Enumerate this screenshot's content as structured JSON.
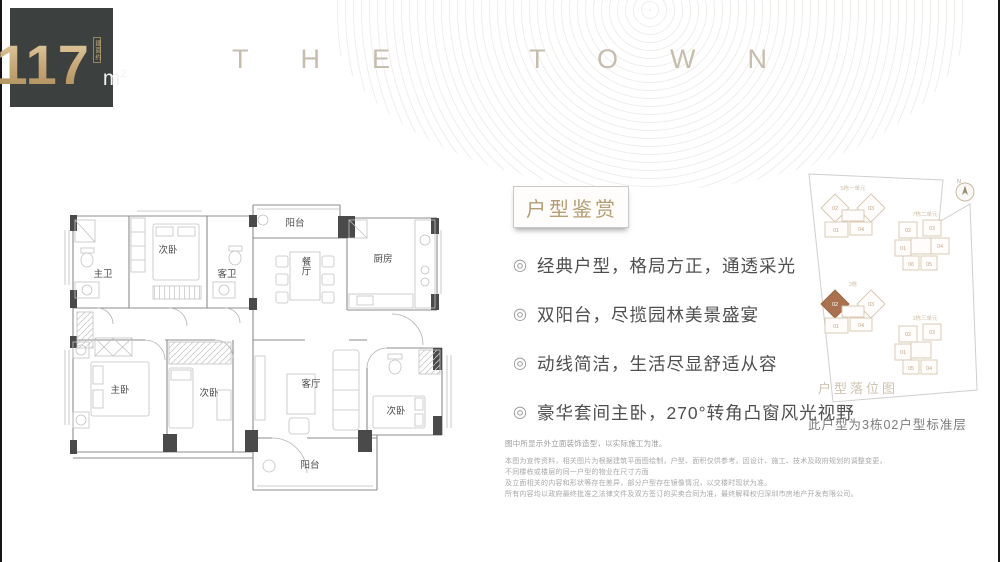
{
  "badge": {
    "prefix_vertical": "建面约",
    "value": "117",
    "unit_base": "m",
    "unit_exp": "2"
  },
  "brand": {
    "text": "THE TOWN"
  },
  "floorplan": {
    "labels": {
      "balcony_top": "阳台",
      "bedroom_top": "次卧",
      "master_bath": "主卫",
      "guest_bath": "客卫",
      "dining": "餐厅",
      "kitchen": "厨房",
      "master_bedroom": "主卧",
      "bedroom_mid": "次卧",
      "living_room": "客厅",
      "bedroom_right": "次卧",
      "balcony_bottom": "阳台"
    }
  },
  "features": {
    "title": "户型鉴赏",
    "bullet_icon": "◎",
    "items": [
      "经典户型，格局方正，通透采光",
      "双阳台，尽揽园林美景盛宴",
      "动线简洁，生活尽显舒适从容",
      "豪华套间主卧，270°转角凸窗风光视野"
    ]
  },
  "siteplan": {
    "title": "户型落位图",
    "caption": "此户型为3栋02户型标准层",
    "compass_label": "N",
    "highlight_color": "#aa7150",
    "clusters": {
      "a": {
        "label": "5栋一单元",
        "u1": "02",
        "u2": "03",
        "u3": "01",
        "u4": "04"
      },
      "b": {
        "label": "3栋",
        "u1": "02",
        "u2": "03",
        "u3": "01",
        "u4": "04"
      },
      "c": {
        "label": "7栋二单元",
        "u1": "02",
        "u2": "03",
        "u3": "01",
        "u4": "04",
        "u5": "06",
        "u6": "05"
      },
      "d": {
        "label": "1栋三单元",
        "u1": "02",
        "u2": "03",
        "u3": "01",
        "u4": "05",
        "u5": "04"
      }
    }
  },
  "disclaimer": {
    "line1": "图中所显示外立面装饰造型，以实际施工为准。",
    "para1": "本图为宣传资料，相关图片为根据建筑平面图绘制，户型、面积仅供参考，因设计、施工、技术及政府规划的调整变更，不同楼栋或楼层的同一户型的物业在尺寸方面",
    "para2": "及立面相关的内容和形状等存在差异，部分户型存在镜像情况，以交楼时现状为准。",
    "para3": "所有内容均以政府最终批准之法律文件及双方签订的买卖合同为准，最终解释权归深圳市房地产开发有限公司。"
  }
}
